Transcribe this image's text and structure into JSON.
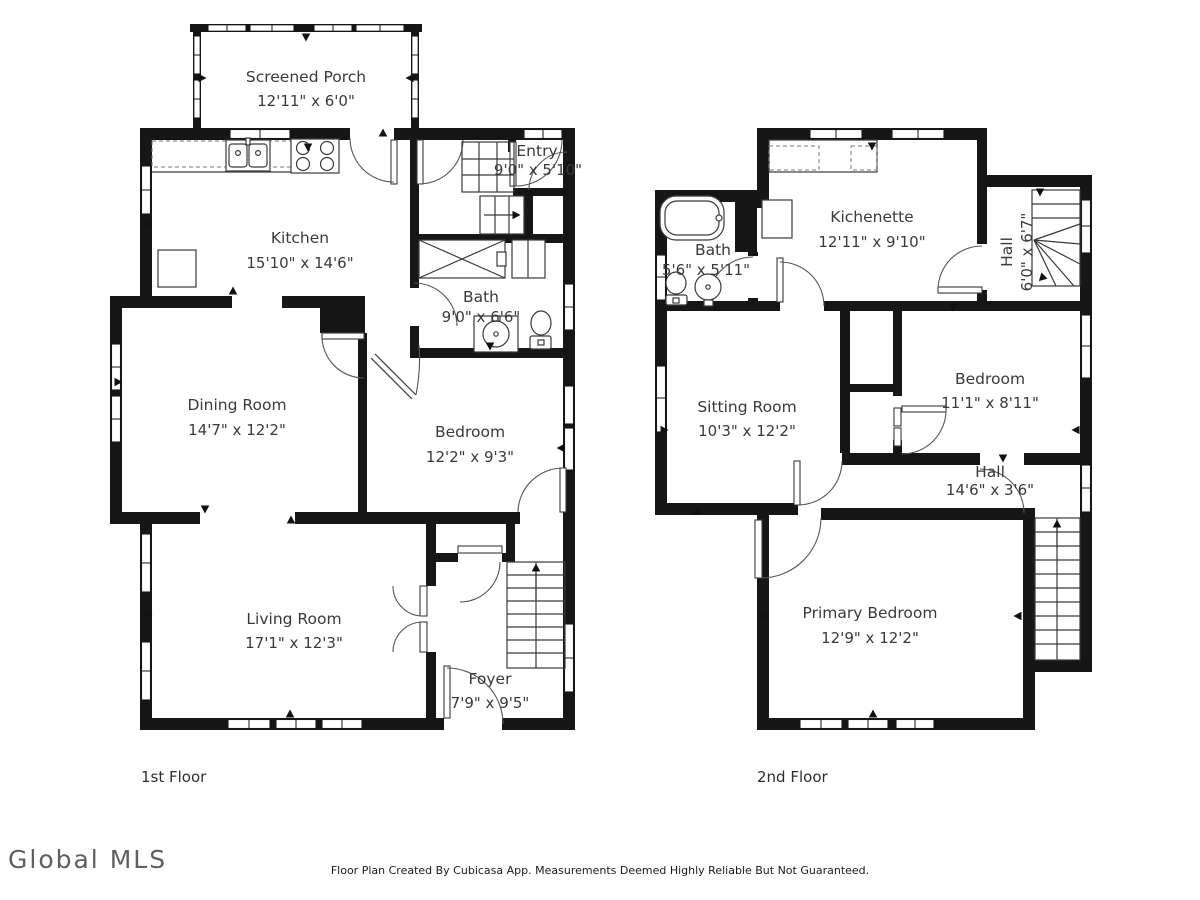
{
  "floor1": {
    "label": "1st Floor",
    "rooms": {
      "screened_porch": {
        "name": "Screened Porch",
        "dims": "12'11\" x 6'0\""
      },
      "kitchen": {
        "name": "Kitchen",
        "dims": "15'10\" x 14'6\""
      },
      "entry": {
        "name": "Entry",
        "dims": "9'0\" x 5'10\""
      },
      "bath": {
        "name": "Bath",
        "dims": "9'0\" x 6'6\""
      },
      "dining_room": {
        "name": "Dining Room",
        "dims": "14'7\" x 12'2\""
      },
      "bedroom": {
        "name": "Bedroom",
        "dims": "12'2\" x 9'3\""
      },
      "living_room": {
        "name": "Living Room",
        "dims": "17'1\" x 12'3\""
      },
      "foyer": {
        "name": "Foyer",
        "dims": "7'9\" x 9'5\""
      }
    }
  },
  "floor2": {
    "label": "2nd Floor",
    "rooms": {
      "kichenette": {
        "name": "Kichenette",
        "dims": "12'11\" x 9'10\""
      },
      "bath": {
        "name": "Bath",
        "dims": "5'6\" x 5'11\""
      },
      "hall_upper": {
        "name": "Hall",
        "dims": "6'0\" x 6'7\""
      },
      "sitting_room": {
        "name": "Sitting Room",
        "dims": "10'3\" x 12'2\""
      },
      "bedroom": {
        "name": "Bedroom",
        "dims": "11'1\" x 8'11\""
      },
      "hall": {
        "name": "Hall",
        "dims": "14'6\" x 3'6\""
      },
      "primary_bedroom": {
        "name": "Primary Bedroom",
        "dims": "12'9\" x 12'2\""
      }
    }
  },
  "footer": {
    "logo": "Global MLS",
    "disclaimer": "Floor Plan Created By Cubicasa App. Measurements Deemed Highly Reliable But Not Guaranteed."
  },
  "colors": {
    "wall": "#161616",
    "background": "#ffffff",
    "label_text": "#3a3a3a"
  }
}
